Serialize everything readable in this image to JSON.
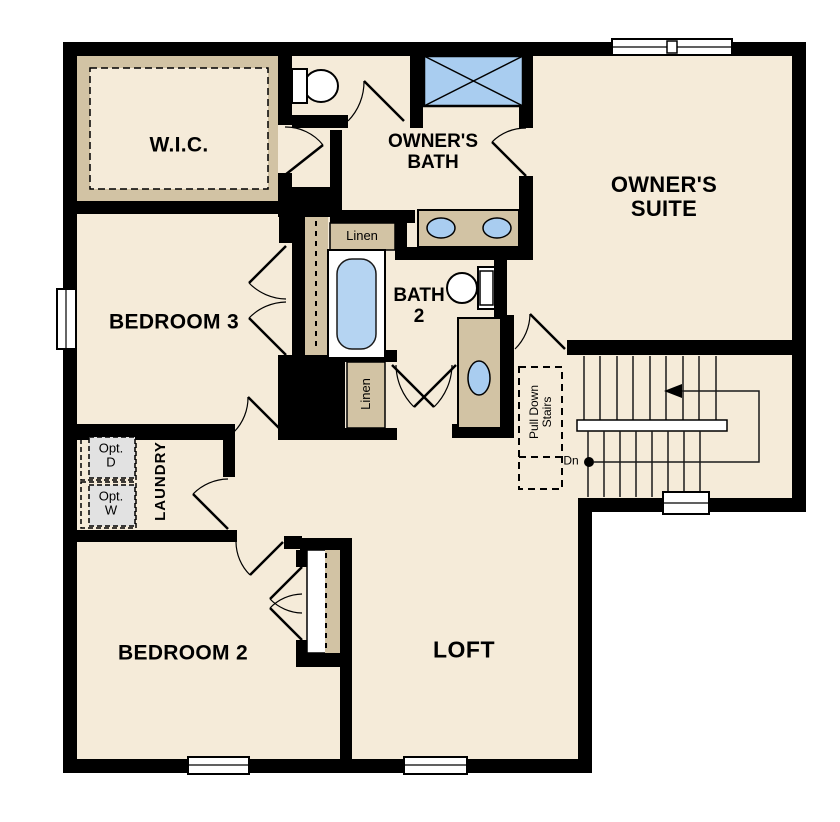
{
  "rooms": {
    "wic": {
      "label": "W.I.C."
    },
    "owners_bath": {
      "line1": "OWNER'S",
      "line2": "BATH"
    },
    "owners_suite": {
      "line1": "OWNER'S",
      "line2": "SUITE"
    },
    "bedroom3": {
      "label": "BEDROOM 3"
    },
    "bath2": {
      "line1": "BATH",
      "line2": "2"
    },
    "bedroom2": {
      "label": "BEDROOM 2"
    },
    "loft": {
      "label": "LOFT"
    },
    "laundry": {
      "label": "LAUNDRY"
    }
  },
  "closets": {
    "linen_upper": {
      "label": "Linen"
    },
    "linen_lower": {
      "label": "Linen"
    }
  },
  "appliances": {
    "optional_dryer": {
      "line1": "Opt.",
      "line2": "D"
    },
    "optional_washer": {
      "line1": "Opt.",
      "line2": "W"
    }
  },
  "stairs": {
    "pull_down_line1": "Pull Down",
    "pull_down_line2": "Stairs",
    "down_label": "Dn"
  },
  "colors": {
    "floor": "#f5ebd9",
    "wall": "#000000",
    "cabinetry_tan": "#d2c3a4",
    "fixture_blue": "#a9cdf0",
    "tub_blue": "#b5d4f2",
    "option_gray": "#e2e2e2",
    "outside": "#ffffff"
  }
}
